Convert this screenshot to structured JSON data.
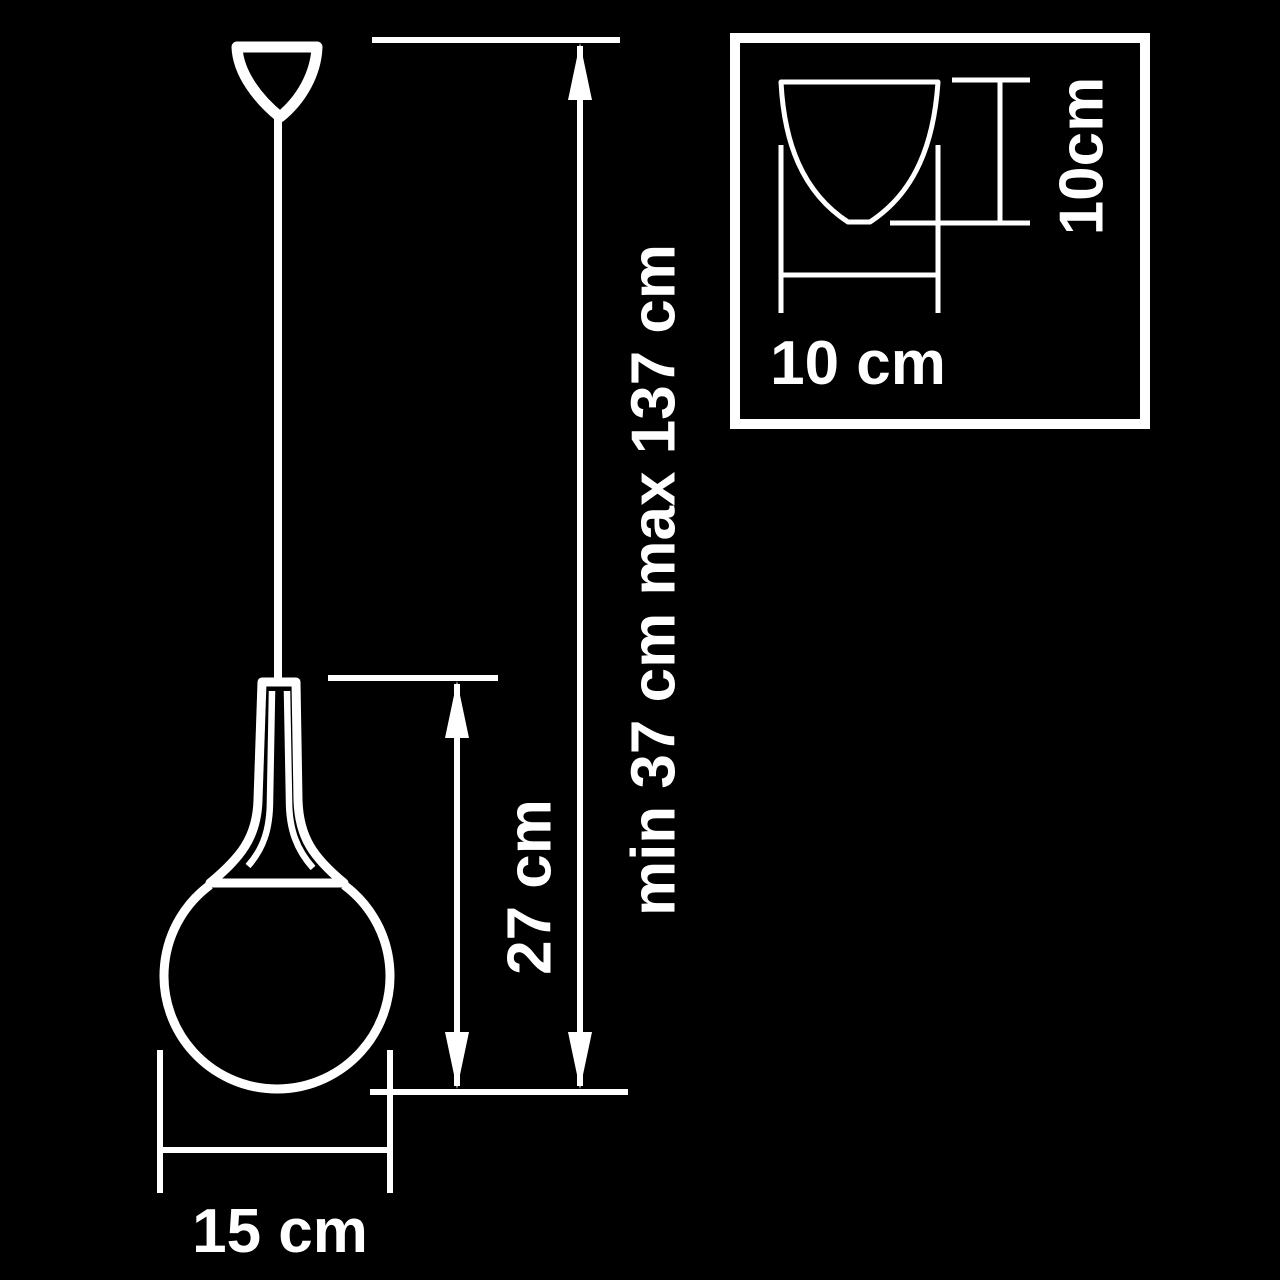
{
  "colors": {
    "background": "#000000",
    "line": "#ffffff"
  },
  "diagram": {
    "type": "pendant-light-dimension-drawing",
    "dimensions": {
      "suspension_total": "min 37 cm max 137 cm",
      "shade_height": "27 cm",
      "shade_diameter": "15 cm",
      "canopy_width": "10 cm",
      "canopy_height": "10cm"
    }
  }
}
